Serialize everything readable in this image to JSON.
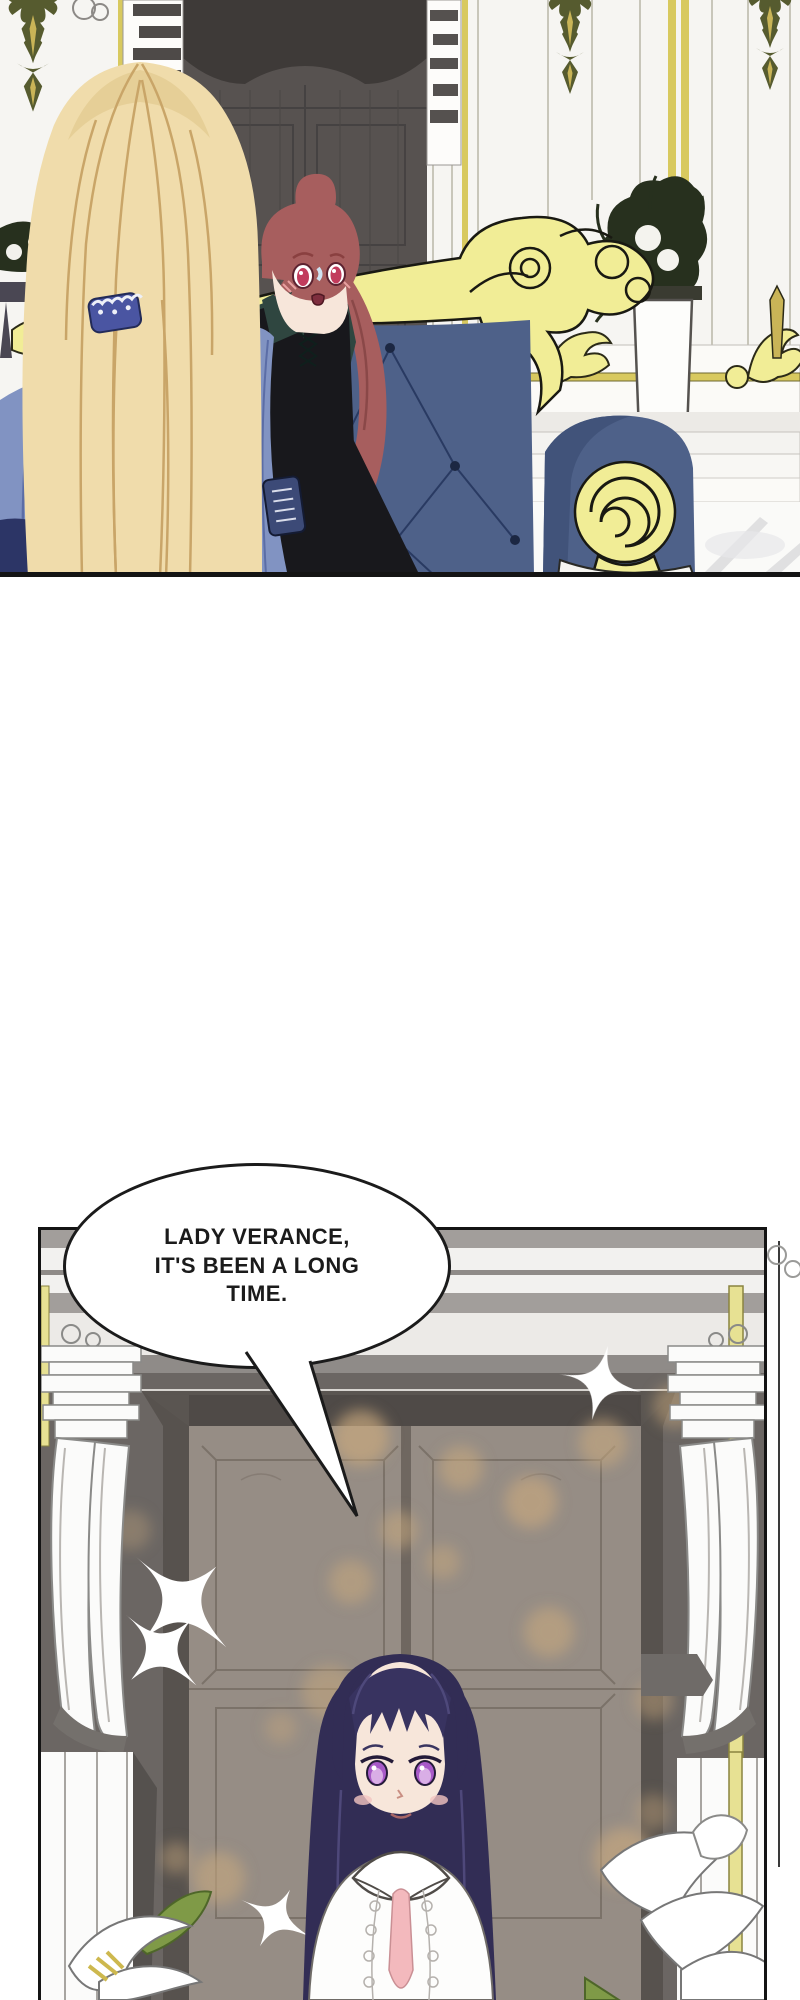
{
  "page": {
    "kind": "webtoon comic page",
    "panel_count": 2
  },
  "speech": {
    "speaker_bubble": "oval",
    "lines": [
      "LADY VERANCE,",
      "IT'S BEEN A LONG",
      "TIME."
    ],
    "full_text": "LADY VERANCE, IT'S BEEN A LONG TIME."
  },
  "colors": {
    "paper": "#ffffff",
    "ink": "#1b1b1b",
    "panel_border": "#141414",
    "wall_white": "#f6f5f2",
    "wall_line": "#b9b6a8",
    "door_gray": "#575250",
    "door_valance": "#3e3a38",
    "door_line": "#434040",
    "gold_pale": "#f1ed96",
    "gold_line": "#d8c95f",
    "gold_deep": "#5d5c2c",
    "finial_olive": "#565b2f",
    "finial_gold": "#c9b457",
    "sofa_blue": "#4e6189",
    "sofa_shadow": "#41537a",
    "sofa_line": "#26365e",
    "hair_blonde": "#f0dcab",
    "hair_blonde_shadow": "#e6cf97",
    "hair_strand": "#c9a568",
    "hair_red": "#a75e5e",
    "hair_red_dark": "#8a4848",
    "skin": "#f7e6da",
    "eye_red": "#c23b5c",
    "mouth_red": "#7e2e3e",
    "jacket_teal": "#2f4640",
    "coat_black": "#18181c",
    "drape_blue": "#8193c2",
    "drape_blue_line": "#5b6da6",
    "clip_blue": "#4a55a2",
    "badge_blue": "#3c4a77",
    "plant_green": "#27301e",
    "floor_white": "#fafaf8",
    "floor_vein": "#d9d9db",
    "p2_bg": "#6b6663",
    "p2_stripe_gray": "#a29e9b",
    "p2_stripe_dark": "#8f8b88",
    "p2_white": "#f2f1ef",
    "door2": "#968d85",
    "door2_dark": "#6f6760",
    "door2_line": "#7b7269",
    "door2_top": "#4f4a47",
    "bokeh": "#c7a87e",
    "gold_strip": "#e7e193",
    "gold_strip_line": "#8a8440",
    "column_white": "#fbfbfa",
    "column_line": "#8a8a88",
    "hair_navy": "#322d55",
    "hair_navy_hi": "#514b7e",
    "eye_purple": "#a85ac8",
    "eye_purple_light": "#d9aee6",
    "blush": "#f2c4c0",
    "ribbon_pink": "#f3b9bd",
    "blouse": "#fdfdfc",
    "lace_line": "#b5b1ad",
    "leaf": "#7f9a47",
    "leaf_dark": "#4e6629",
    "bubble_bg": "#ffffff",
    "sparkle": "#ffffff"
  }
}
